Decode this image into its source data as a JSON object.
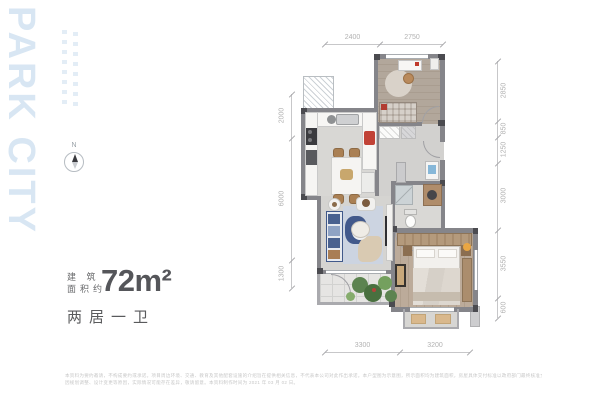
{
  "brand": {
    "name": "PARK CITY"
  },
  "compass": {
    "north_label": "N"
  },
  "area": {
    "label_line1": "建 筑",
    "label_line2": "面积约",
    "value": "72m²",
    "layout": "两居一卫"
  },
  "plan": {
    "dimensions_mm": {
      "top": [
        "2400",
        "2750"
      ],
      "right": [
        "2850",
        "850",
        "1250",
        "3000",
        "3550",
        "600"
      ],
      "bottom": [
        "3300",
        "3200"
      ],
      "left": [
        "2000",
        "6000",
        "1300"
      ]
    }
  },
  "disclaimer": {
    "line1": "本资料为要约邀请，不构成要约或承诺。项目周边环境、交通、教育及其他配套设施的介绍旨在提供相关信息，不代表本公司对此作出承诺。本户型图为示意图，所示面积均为建筑面积，房屋具体交付标准以政府部门最终核准文件及双方签订的《商品房买卖合同》约定为准，图中部分家具、绿植、装饰仅为示意，不属于交付标准。",
    "line2": "因规划调整、设计变更等原因，实际情况可能存在差异，敬请留意。本资料制作时间为 2021 年 03 月 02 日。"
  },
  "accent_colors": {
    "brand_blue": "#d8e6f3",
    "title_gray": "#55565a",
    "dimension_gray": "#b2b2b2",
    "sofa_navy": "#42598b",
    "accent_red": "#c0392b",
    "wood": "#b49a7c"
  }
}
